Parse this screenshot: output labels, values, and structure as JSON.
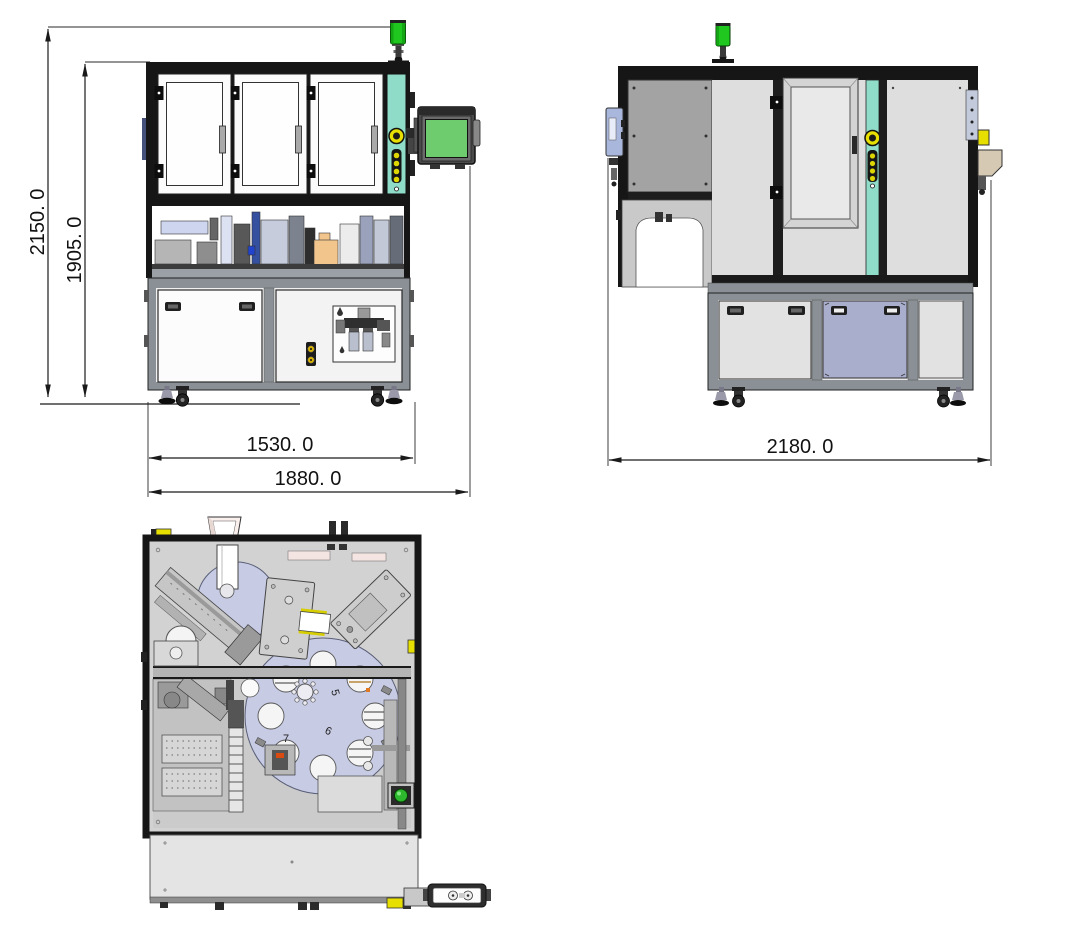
{
  "drawing": {
    "dimensions": {
      "overall_height": "2150. 0",
      "frame_height": "1905. 0",
      "front_inner_width": "1530. 0",
      "front_overall_width": "1880. 0",
      "side_overall_width": "2180. 0"
    },
    "top_view_station_labels": {
      "s5": "5",
      "s6": "6",
      "s7": "7"
    },
    "colors": {
      "frame": "#161616",
      "teal_column": "#8fdcc8",
      "screen_green": "#6ecc6e",
      "signal_green": "#1fc71f",
      "button_yellow": "#e6df00",
      "lavender": "#c7cbe4",
      "blue_door": "#a9aecd",
      "blue_box": "#aab7dc",
      "orange_part": "#f2c58c",
      "tan_bracket": "#d6c9b4",
      "start_green": "#2db82d",
      "cabinet_gray": "#8a9095"
    }
  }
}
